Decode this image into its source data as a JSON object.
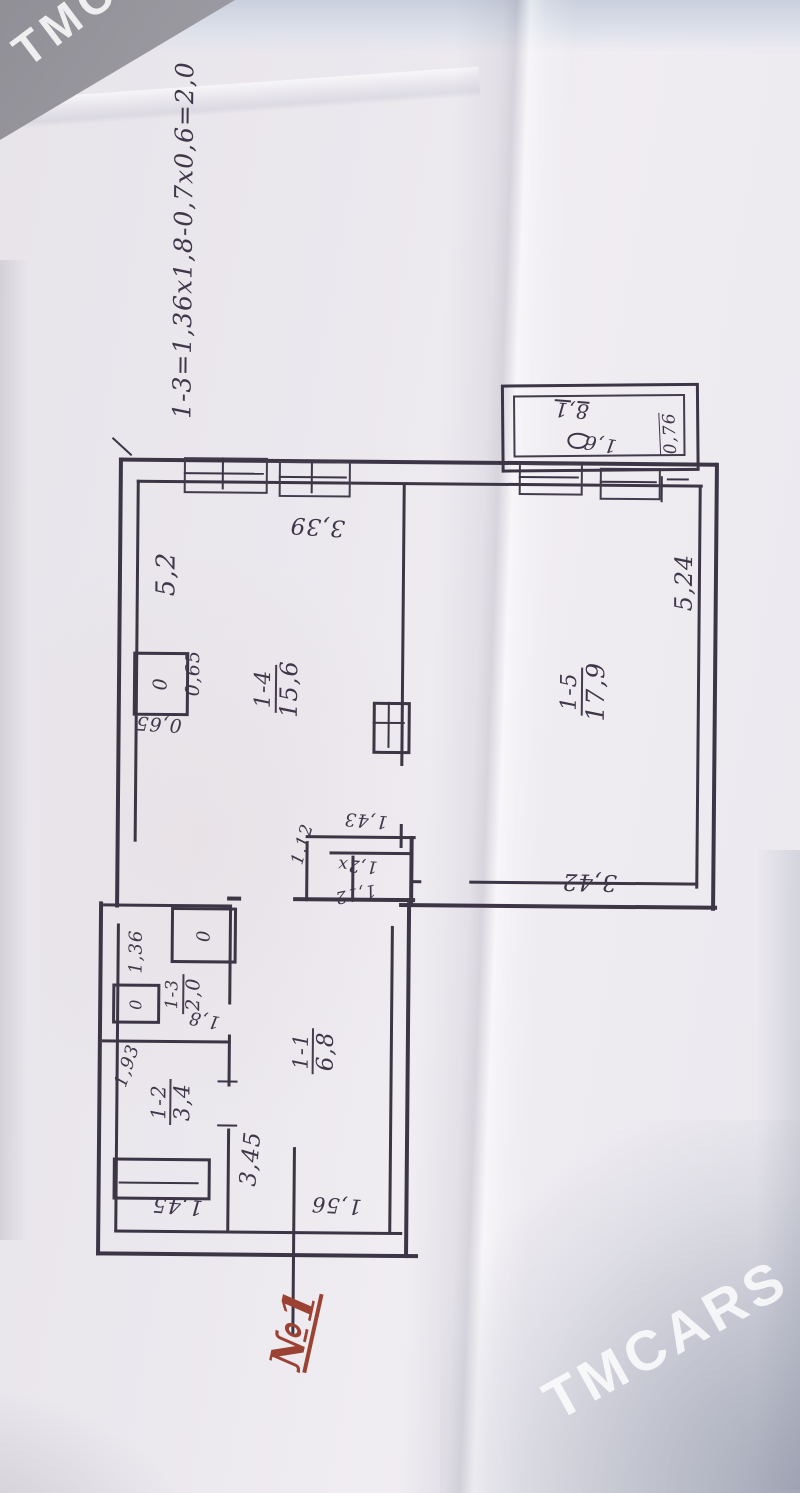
{
  "watermark": {
    "text": "TMCARS"
  },
  "plan": {
    "formula": "1-3=1,36х1,8-0,7х0,6=2,0",
    "entrance_mark": "№1",
    "rooms": {
      "hall": {
        "id": "1-1",
        "area": "6,8"
      },
      "bath": {
        "id": "1-2",
        "area": "3,4"
      },
      "wc": {
        "id": "1-3",
        "area": "2,0"
      },
      "kitchen": {
        "id": "1-4",
        "area": "15,6"
      },
      "living": {
        "id": "1-5",
        "area": "17,9"
      }
    },
    "dims": {
      "kitchen_width": "3,39",
      "kitchen_length": "5,2",
      "stove_side": "0,65",
      "stove_front": "0,65",
      "living_length": "5,24",
      "living_width": "3,42",
      "closet_depth": "1,43",
      "closet_width": "1,12",
      "closet_b": "1,2х",
      "closet_b_width": "1,12",
      "wc_width": "1,36",
      "wc_length": "1,8",
      "bath_width": "1,93",
      "tub_length": "1,45",
      "hall_length": "3,45",
      "hall_width": "1,56",
      "balcony_num": "8,1",
      "balcony_area": "1,6",
      "balcony_depth": "0,76"
    },
    "fixtures": {
      "stove": "0",
      "basin": "0",
      "wc_pan": "0"
    }
  }
}
